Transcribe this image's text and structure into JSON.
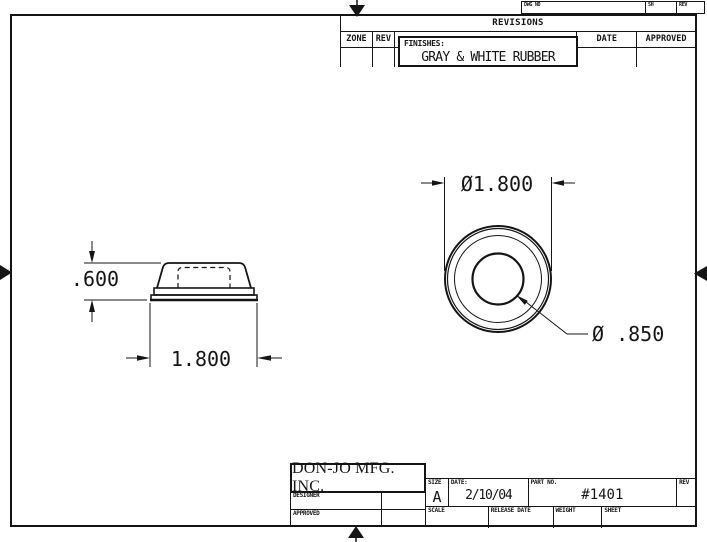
{
  "colors": {
    "line": "#151515",
    "bg": "#ffffff"
  },
  "dwg_strip": {
    "dwg_no_label": "DWG NO",
    "sh_label": "SH",
    "rev_label": "REV"
  },
  "revisions": {
    "title": "REVISIONS",
    "zone_label": "ZONE",
    "rev_label": "REV",
    "date_label": "DATE",
    "approved_label": "APPROVED",
    "finishes_label": "FINISHES:",
    "finishes_value": "GRAY & WHITE RUBBER"
  },
  "dimensions": {
    "side_height": ".600",
    "side_width": "1.800",
    "top_outer_diameter": "Ø1.800",
    "top_hole_diameter": "Ø .850"
  },
  "title_block": {
    "company": "DON-JO MFG. INC.",
    "designer_label": "DESIGNER",
    "approved_label": "APPROVED",
    "size_label": "SIZE",
    "size_value": "A",
    "date_label": "DATE:",
    "date_value": "2/10/04",
    "part_no_label": "PART NO.",
    "part_no_value": "#1401",
    "rev_label": "REV",
    "scale_label": "SCALE",
    "release_date_label": "RELEASE DATE",
    "weight_label": "WEIGHT",
    "sheet_label": "SHEET"
  }
}
